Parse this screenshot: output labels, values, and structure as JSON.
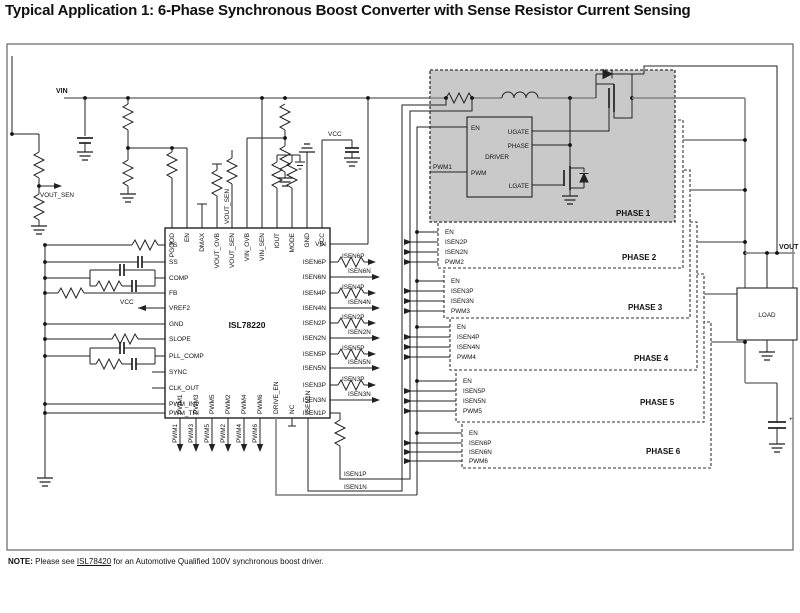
{
  "title": "Typical Application 1: 6-Phase Synchronous Boost Converter with Sense Resistor Current Sensing",
  "note": {
    "label": "NOTE:",
    "pre": "  Please see ",
    "link": "ISL78420",
    "post": " for an Automotive Qualified 100V synchronous boost driver."
  },
  "colors": {
    "wire": "#222222",
    "power_rail": "#8c8c8c",
    "phase1_fill": "#c9c9c9",
    "background": "#ffffff"
  },
  "labels": {
    "vin": "VIN",
    "vout": "VOUT",
    "vcc_top": "VCC",
    "vcc_ref": "VCC",
    "vout_sen_net": "VOUT_SEN",
    "vout_sen_pin_net": "VOUT_SEN",
    "load": "LOAD",
    "isen1p": "ISEN1P",
    "isen1n": "ISEN1N",
    "plus": "+"
  },
  "ic": {
    "name": "ISL78220",
    "left_pins": [
      "FS",
      "SS",
      "COMP",
      "FB",
      "VREF2",
      "GND",
      "SLOPE",
      "PLL_COMP",
      "SYNC",
      "CLK_OUT",
      "PWM_INV",
      "PWM_TRI"
    ],
    "top_pins": [
      "PGOOD",
      "EN",
      "DMAX",
      "VOUT_OVB",
      "VOUT_SEN",
      "VIN_OVB",
      "VIN_SEN",
      "IOUT",
      "MODE",
      "GND",
      "VCC"
    ],
    "right_pins": [
      "VIN",
      "ISEN6P",
      "ISEN6N",
      "ISEN4P",
      "ISEN4N",
      "ISEN2P",
      "ISEN2N",
      "ISEN5P",
      "ISEN5N",
      "ISEN3P",
      "ISEN3N",
      "ISEN1P"
    ],
    "bottom_pins": [
      "PWM1",
      "PWM3",
      "PWM5",
      "PWM2",
      "PWM4",
      "PWM6",
      "DRIVE_EN",
      "NC",
      "ISEN1N"
    ]
  },
  "signals": {
    "isen_out": [
      "ISEN6P",
      "ISEN6N",
      "ISEN4P",
      "ISEN4N",
      "ISEN2P",
      "ISEN2N",
      "ISEN5P",
      "ISEN5N",
      "ISEN3P",
      "ISEN3N"
    ],
    "pwm_out": [
      "PWM1",
      "PWM3",
      "PWM5",
      "PWM2",
      "PWM4",
      "PWM6"
    ]
  },
  "driver": {
    "title": "DRIVER",
    "en": "EN",
    "pwm": "PWM",
    "ugate": "UGATE",
    "phase": "PHASE",
    "lgate": "LGATE",
    "pwm_in": "PWM1"
  },
  "phases": [
    {
      "title": "PHASE 1"
    },
    {
      "title": "PHASE 2",
      "pins": [
        "EN",
        "ISEN2P",
        "ISEN2N",
        "PWM2"
      ]
    },
    {
      "title": "PHASE 3",
      "pins": [
        "EN",
        "ISEN3P",
        "ISEN3N",
        "PWM3"
      ]
    },
    {
      "title": "PHASE 4",
      "pins": [
        "EN",
        "ISEN4P",
        "ISEN4N",
        "PWM4"
      ]
    },
    {
      "title": "PHASE 5",
      "pins": [
        "EN",
        "ISEN5P",
        "ISEN5N",
        "PWM5"
      ]
    },
    {
      "title": "PHASE 6",
      "pins": [
        "EN",
        "ISEN6P",
        "ISEN6N",
        "PWM6"
      ]
    }
  ]
}
